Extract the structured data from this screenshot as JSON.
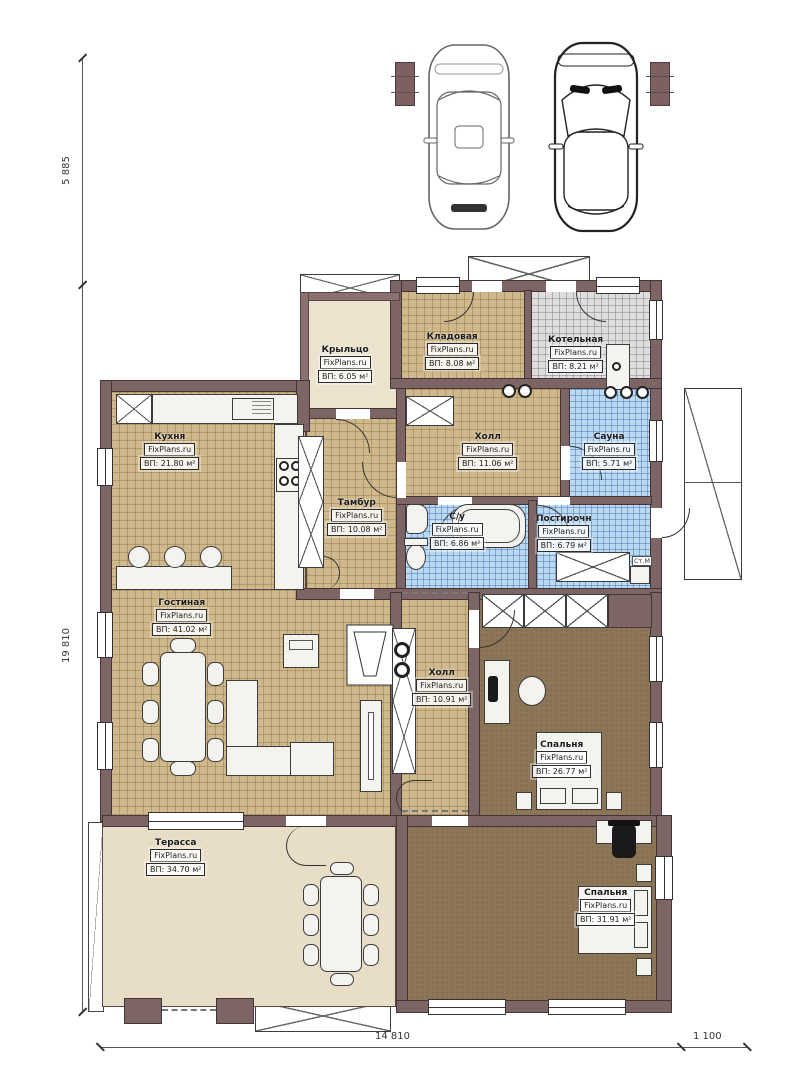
{
  "meta": {
    "watermark": "FixPlans.ru",
    "drawing_type": "Поэтажный план одноэтажного дома"
  },
  "dimensions": {
    "left_top": "5 885",
    "left_main": "19 810",
    "bottom_main": "14 810",
    "bottom_right": "1 100"
  },
  "rooms": {
    "porch": {
      "name": "Крыльцо",
      "area": "ВП: 6.05 м²"
    },
    "storage": {
      "name": "Кладовая",
      "area": "ВП: 8.08 м²"
    },
    "boiler": {
      "name": "Котельная",
      "area": "ВП: 8.21 м²"
    },
    "kitchen": {
      "name": "Кухня",
      "area": "ВП: 21.80 м²"
    },
    "vestibule": {
      "name": "Тамбур",
      "area": "ВП: 10.08 м²"
    },
    "hall_upper": {
      "name": "Холл",
      "area": "ВП: 11.06 м²"
    },
    "sauna": {
      "name": "Сауна",
      "area": "ВП: 5.71 м²"
    },
    "bathroom": {
      "name": "С/у",
      "area": "ВП: 6.86 м²"
    },
    "laundry": {
      "name": "Постирочн",
      "area": "ВП: 6.79 м²"
    },
    "living": {
      "name": "Гостиная",
      "area": "ВП: 41.02 м²"
    },
    "hall_main": {
      "name": "Холл",
      "area": "ВП: 10.91 м²"
    },
    "bedroom1": {
      "name": "Спальня",
      "area": "ВП: 26.77 м²"
    },
    "terrace": {
      "name": "Терасса",
      "area": "ВП: 34.70 м²"
    },
    "bedroom2": {
      "name": "Спальня",
      "area": "ВП: 31.91 м²"
    }
  },
  "annotations": {
    "washer": "Ст.М"
  },
  "colors": {
    "wall": "#7e6565",
    "tile_tan": "#cfb98c",
    "tile_gray": "#e0dedd",
    "tile_blue": "#bcd9f2",
    "bedroom_floor": "#8d7557",
    "terrace_floor": "#e8ddc7",
    "porch_floor": "#ece3cf"
  }
}
